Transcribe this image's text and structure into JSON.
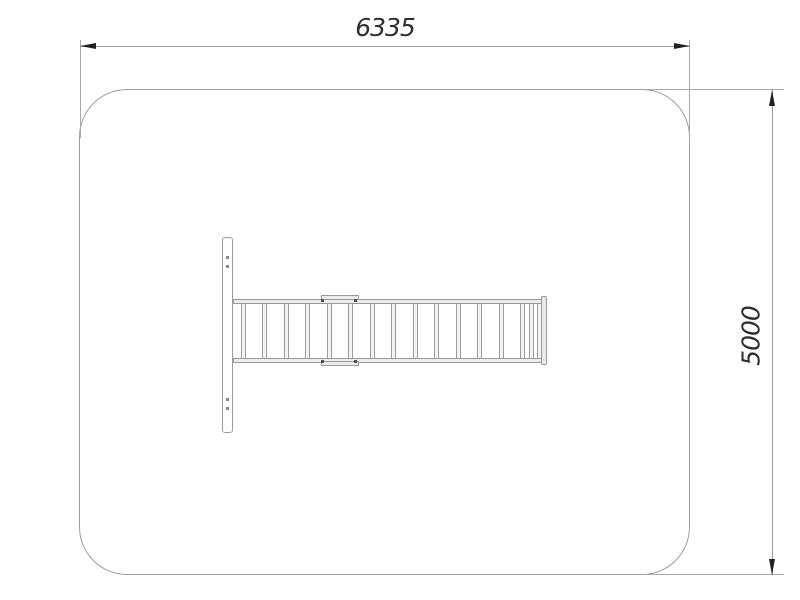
{
  "dimensions": {
    "width_label": "6335",
    "height_label": "5000"
  },
  "equipment": {
    "name": "horizontal-ladder-with-end-panel-top-view",
    "rung_count": 16,
    "panel_hole_count": 4,
    "segment_joint_bolt_count": 4
  },
  "colors": {
    "background": "#ffffff",
    "outline": "#9c9c9c",
    "arrowhead": "#222222",
    "label_text": "#2e2e2e"
  }
}
